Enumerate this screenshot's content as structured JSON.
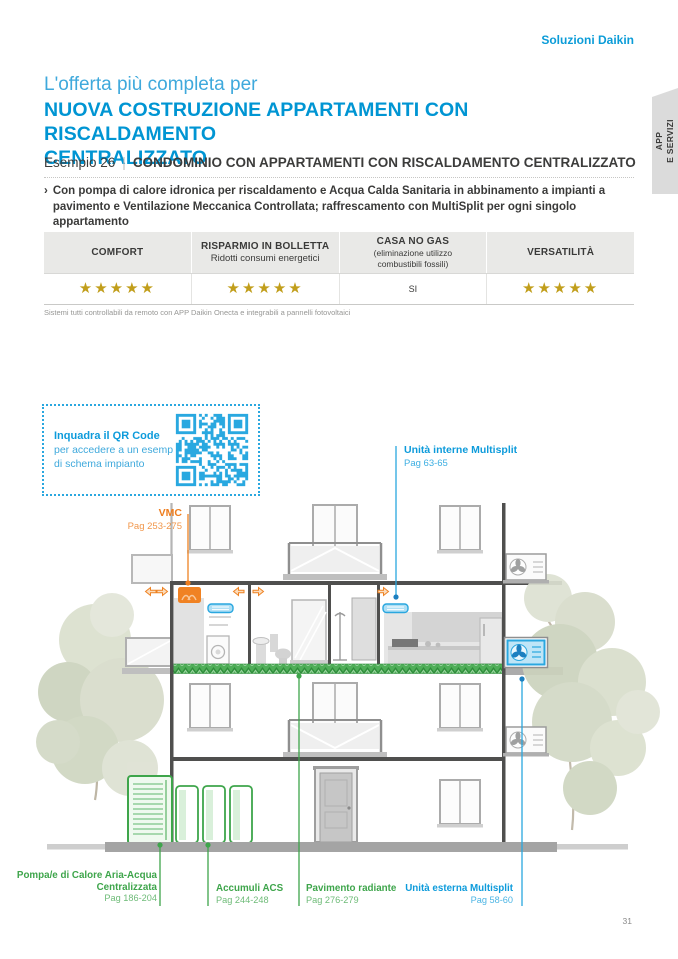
{
  "brand": "Soluzioni Daikin",
  "side_tab": {
    "line1": "APP",
    "line2": "E SERVIZI"
  },
  "header": {
    "kicker": "L'offerta più completa per",
    "title_line1": "NUOVA COSTRUZIONE APPARTAMENTI CON RISCALDAMENTO",
    "title_line2": "CENTRALIZZATO",
    "example_label": "Esempio 26",
    "example_separator": "|",
    "example_title": "CONDOMINIO CON APPARTAMENTI CON RISCALDAMENTO CENTRALIZZATO",
    "bullet_marker": "›",
    "bullet_text": "Con pompa di calore idronica per riscaldamento e Acqua Calda Sanitaria in abbinamento a impianti a pavimento e Ventilazione Meccanica Controllata; raffrescamento con MultiSplit per ogni singolo appartamento"
  },
  "table": {
    "columns": [
      {
        "header": "COMFORT",
        "subheader": "",
        "stars": "★★★★★",
        "text": "",
        "rating": 5
      },
      {
        "header": "RISPARMIO IN BOLLETTA",
        "subheader": "Ridotti consumi energetici",
        "stars": "★★★★★",
        "text": "",
        "rating": 5
      },
      {
        "header": "CASA NO GAS",
        "subheader": "(eliminazione utilizzo combustibili fossili)",
        "stars": "",
        "text": "SI",
        "rating": null
      },
      {
        "header": "VERSATILITÀ",
        "subheader": "",
        "stars": "★★★★★",
        "text": "",
        "rating": 5
      }
    ],
    "footnote": "Sistemi tutti controllabili da remoto con APP Daikin Onecta e integrabili a pannelli fotovoltaici"
  },
  "qr_box": {
    "title": "Inquadra il QR Code",
    "line1": "per accedere a un esempio",
    "line2": "di schema impianto"
  },
  "diagram_labels": {
    "vmc": {
      "name": "VMC",
      "pages": "Pag 253-275"
    },
    "indoor_multisplit": {
      "name": "Unità interne Multisplit",
      "pages": "Pag 63-65"
    },
    "heat_pump": {
      "name_line1": "Pompa/e di Calore Aria-Acqua",
      "name_line2": "Centralizzata",
      "pages": "Pag 186-204"
    },
    "acs_tanks": {
      "name": "Accumuli ACS",
      "pages": "Pag 244-248"
    },
    "radiant_floor": {
      "name": "Pavimento radiante",
      "pages": "Pag 276-279"
    },
    "outdoor_multisplit": {
      "name": "Unità esterna Multisplit",
      "pages": "Pag 58-60"
    }
  },
  "page_number": "31",
  "colors": {
    "daikin_blue": "#0095D3",
    "light_blue": "#3FA9DC",
    "qr_blue": "#29A8E0",
    "orange": "#EE7D1E",
    "green": "#3EA54B",
    "star_gold": "#C19E1B",
    "table_header_bg": "#E9E9E7",
    "dark_text": "#3A3A39"
  }
}
